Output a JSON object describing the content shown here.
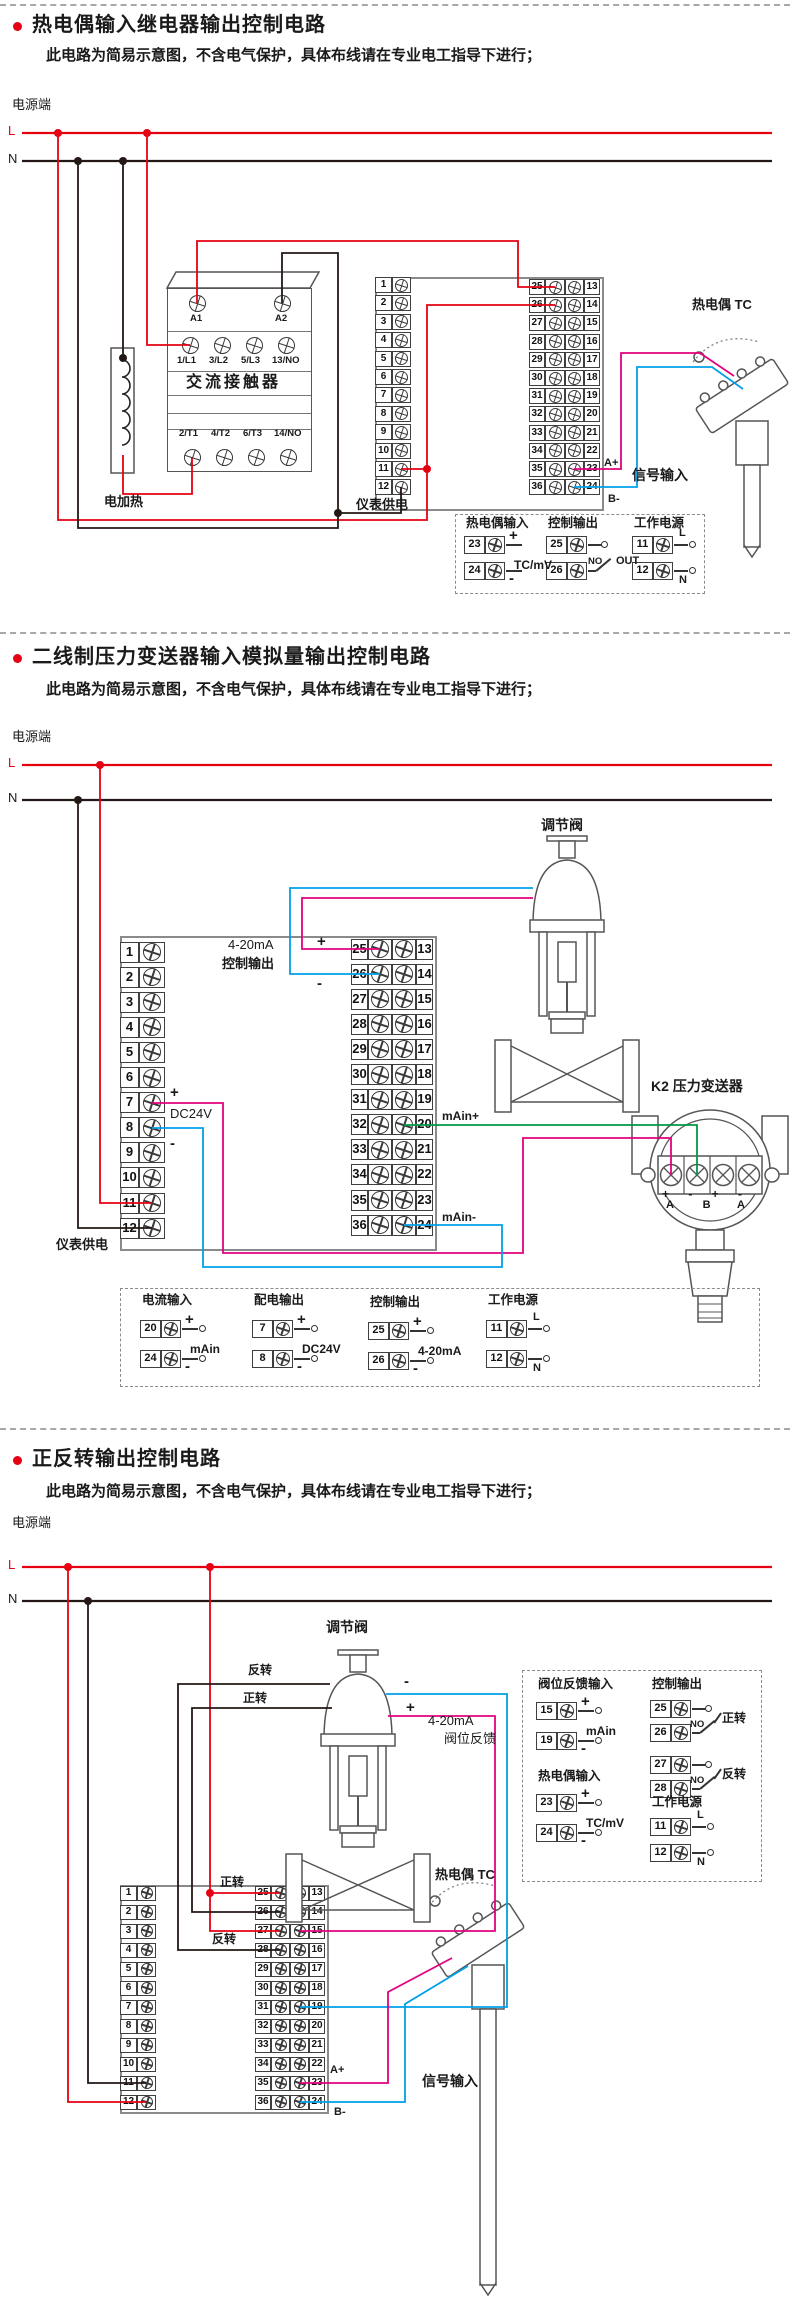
{
  "colors": {
    "red": "#e60012",
    "black": "#231815",
    "magenta": "#e4007f",
    "blue": "#00a0e9",
    "green": "#009944",
    "gray": "#8a8a8a"
  },
  "sections": [
    {
      "title": "热电偶输入继电器输出控制电路",
      "subtitle": "此电路为简易示意图，不含电气保护，具体布线请在专业电工指导下进行；",
      "power_label": "电源端",
      "line_l": "L",
      "line_n": "N",
      "contactor": {
        "name": "交流接触器",
        "top": [
          "A1",
          "A2"
        ],
        "mid": [
          "1/L1",
          "3/L2",
          "5/L3",
          "13/NO"
        ],
        "bottom": [
          "2/T1",
          "4/T2",
          "6/T3",
          "14/NO"
        ]
      },
      "heater_label": "电加热",
      "meter_supply_label": "仪表供电",
      "terminals_left": [
        "1",
        "2",
        "3",
        "4",
        "5",
        "6",
        "7",
        "8",
        "9",
        "10",
        "11",
        "12"
      ],
      "terminals_right_inner": [
        "25",
        "26",
        "27",
        "28",
        "29",
        "30",
        "31",
        "32",
        "33",
        "34",
        "35",
        "36"
      ],
      "terminals_right_outer": [
        "13",
        "14",
        "15",
        "16",
        "17",
        "18",
        "19",
        "20",
        "21",
        "22",
        "23",
        "24"
      ],
      "wire_labels": {
        "a_plus": "A+",
        "b_minus": "B-",
        "signal_input": "信号输入",
        "tc": "热电偶 TC"
      },
      "legend": {
        "groups": [
          {
            "type": "pair",
            "title": "热电偶输入",
            "rows": [
              [
                "23",
                "+"
              ],
              [
                "24",
                "-"
              ]
            ],
            "note": "TC/mV"
          },
          {
            "type": "relay",
            "title": "控制输出",
            "rows": [
              [
                "25",
                ""
              ],
              [
                "26",
                ""
              ]
            ],
            "contact": "NO",
            "note": "OUT"
          },
          {
            "type": "power",
            "title": "工作电源",
            "rows": [
              [
                "11",
                "L"
              ],
              [
                "12",
                "N"
              ]
            ]
          }
        ]
      }
    },
    {
      "title": "二线制压力变送器输入模拟量输出控制电路",
      "subtitle": "此电路为简易示意图，不含电气保护，具体布线请在专业电工指导下进行；",
      "power_label": "电源端",
      "line_l": "L",
      "line_n": "N",
      "valve_label": "调节阀",
      "output_label_1": "4-20mA",
      "output_label_2": "控制输出",
      "plus": "+",
      "minus": "-",
      "dc24v": "DC24V",
      "main_plus": "mAin+",
      "main_minus": "mAin-",
      "transmitter_label": "K2 压力变送器",
      "transmitter_signs": "+ - + -",
      "transmitter_ab": "A B",
      "transmitter_a2": "A",
      "meter_supply_label": "仪表供电",
      "terminals_left": [
        "1",
        "2",
        "3",
        "4",
        "5",
        "6",
        "7",
        "8",
        "9",
        "10",
        "11",
        "12"
      ],
      "terminals_right_inner": [
        "25",
        "26",
        "27",
        "28",
        "29",
        "30",
        "31",
        "32",
        "33",
        "34",
        "35",
        "36"
      ],
      "terminals_right_outer": [
        "13",
        "14",
        "15",
        "16",
        "17",
        "18",
        "19",
        "20",
        "21",
        "22",
        "23",
        "24"
      ],
      "legend": {
        "groups": [
          {
            "type": "pair",
            "title": "电流输入",
            "rows": [
              [
                "20",
                "+"
              ],
              [
                "24",
                "-"
              ]
            ],
            "note": "mAin"
          },
          {
            "type": "pair",
            "title": "配电输出",
            "rows": [
              [
                "7",
                "+"
              ],
              [
                "8",
                "-"
              ]
            ],
            "note": "DC24V"
          },
          {
            "type": "pair",
            "title": "控制输出",
            "rows": [
              [
                "25",
                "+"
              ],
              [
                "26",
                "-"
              ]
            ],
            "note": "4-20mA"
          },
          {
            "type": "power",
            "title": "工作电源",
            "rows": [
              [
                "11",
                "L"
              ],
              [
                "12",
                "N"
              ]
            ]
          }
        ]
      }
    },
    {
      "title": "正反转输出控制电路",
      "subtitle": "此电路为简易示意图，不含电气保护，具体布线请在专业电工指导下进行；",
      "power_label": "电源端",
      "line_l": "L",
      "line_n": "N",
      "valve_label": "调节阀",
      "rev_top": "反转",
      "fwd_top": "正转",
      "fwd_bottom": "正转",
      "rev_bottom": "反转",
      "plus": "+",
      "minus": "-",
      "feedback_1": "4-20mA",
      "feedback_2": "阀位反馈",
      "terminals_left": [
        "1",
        "2",
        "3",
        "4",
        "5",
        "6",
        "7",
        "8",
        "9",
        "10",
        "11",
        "12"
      ],
      "terminals_right_inner": [
        "25",
        "26",
        "27",
        "28",
        "29",
        "30",
        "31",
        "32",
        "33",
        "34",
        "35",
        "36"
      ],
      "terminals_right_outer": [
        "13",
        "14",
        "15",
        "16",
        "17",
        "18",
        "19",
        "20",
        "21",
        "22",
        "23",
        "24"
      ],
      "wire_labels": {
        "a_plus": "A+",
        "b_minus": "B-",
        "signal_input": "信号输入",
        "tc": "热电偶 TC"
      },
      "legend": {
        "groups": [
          {
            "type": "pair",
            "title": "阀位反馈输入",
            "rows": [
              [
                "15",
                "+"
              ],
              [
                "19",
                "-"
              ]
            ],
            "note": "mAin"
          },
          {
            "type": "relay2",
            "title": "控制输出",
            "pairs": [
              {
                "terminals": [
                  "25",
                  "26"
                ],
                "contact": "NO",
                "note": "正转"
              },
              {
                "terminals": [
                  "27",
                  "28"
                ],
                "contact": "NO",
                "note": "反转"
              }
            ]
          },
          {
            "type": "pair",
            "title": "热电偶输入",
            "rows": [
              [
                "23",
                "+"
              ],
              [
                "24",
                "-"
              ]
            ],
            "note": "TC/mV"
          },
          {
            "type": "power",
            "title": "工作电源",
            "rows": [
              [
                "11",
                "L"
              ],
              [
                "12",
                "N"
              ]
            ]
          }
        ]
      }
    }
  ]
}
